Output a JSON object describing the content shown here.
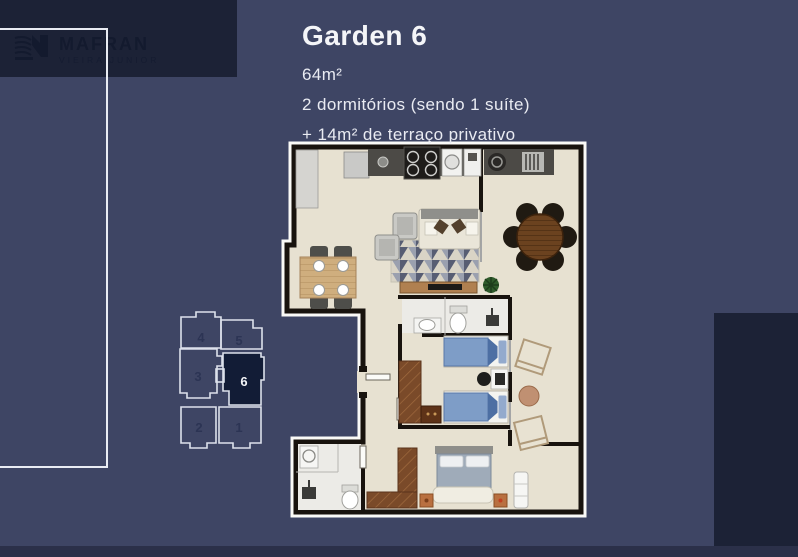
{
  "colors": {
    "background": "#3e4564",
    "dark_panel": "#1c2236",
    "bottom_strip": "#2b3049",
    "border_white": "#e9ecf3",
    "text": "#e9ebf2",
    "keyplan_line": "#dde1ec",
    "keyplan_highlight_fill": "#121c36",
    "plan_floor": "#e7e1d1",
    "plan_wall": "#18130e"
  },
  "logo": {
    "name": "MAFRAN",
    "subtitle": "VIEIRA JUNIOR"
  },
  "header": {
    "title": "Garden 6",
    "area": "64m²",
    "bedrooms": "2 dormitórios (sendo 1 suíte)",
    "terrace": "+ 14m² de terraço privativo"
  },
  "keyplan": {
    "units": [
      {
        "label": "4",
        "highlighted": false
      },
      {
        "label": "5",
        "highlighted": false
      },
      {
        "label": "3",
        "highlighted": false
      },
      {
        "label": "6",
        "highlighted": true
      },
      {
        "label": "2",
        "highlighted": false
      },
      {
        "label": "1",
        "highlighted": false
      }
    ]
  }
}
